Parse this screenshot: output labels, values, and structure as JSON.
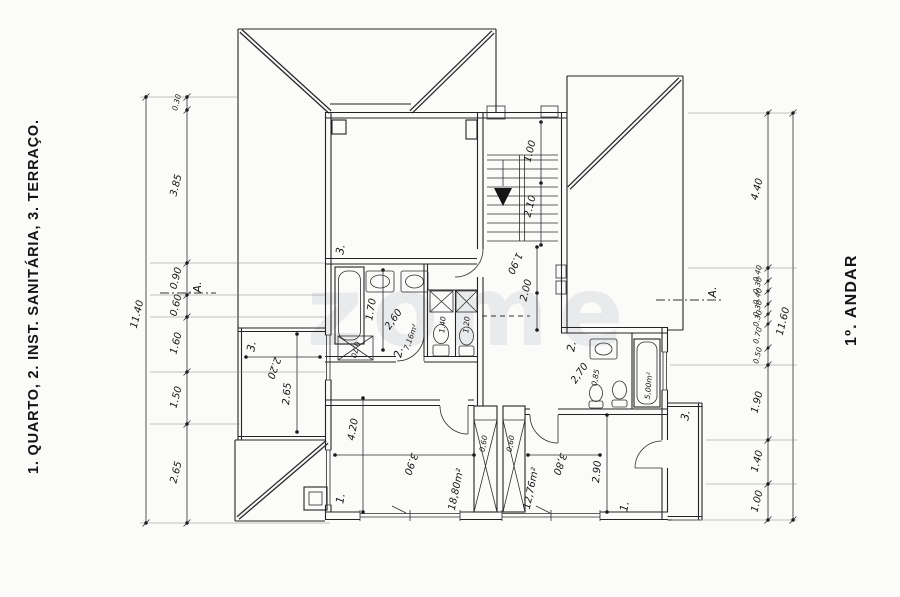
{
  "legend_text": "1. QUARTO, 2. INST.  SANITÁRIA, 3. TERRAÇO.",
  "floor_title": "1º. ANDAR",
  "watermark_text": "zome",
  "section_marker": "A.",
  "dims_left": {
    "total": "11.40",
    "seg1": "0.30",
    "seg2": "3.85",
    "seg3": "0.90",
    "seg4": "0.60",
    "seg5": "1.60",
    "seg6": "1.50",
    "seg7": "2.65"
  },
  "dims_right": {
    "total": "11.60",
    "seg1": "4.40",
    "c1": "0.40",
    "c2": "0.30",
    "c3": "0.40",
    "c4": "0.30",
    "c5": "0.30",
    "c6": "0.70",
    "c7": "0.50",
    "seg2": "1.90",
    "seg3": "1.40",
    "seg4": "1.00"
  },
  "stair": {
    "d1": "1.00",
    "d2": "2.10"
  },
  "hall": {
    "d1": "1.90",
    "d2": "2.00"
  },
  "bath_left": {
    "room_no": "2.",
    "area": "7,16m²",
    "d_tub": "1.70",
    "d_width": "2,60",
    "d_wc1": "1.40",
    "d_wc2": "1.20",
    "d_duct": "0,70"
  },
  "bath_right": {
    "room_no": "2.",
    "area": "5,00m²",
    "d1": "2,70",
    "d2": "0,85"
  },
  "bedroom_left": {
    "room_no": "1.",
    "area": "18,80m²",
    "d_w": "3.90",
    "d_h": "4.20",
    "d_duct": "0,60"
  },
  "bedroom_right": {
    "room_no": "1.",
    "area": "12,76m²",
    "d_w": "3,80",
    "d_h": "2.90",
    "d_duct": "0,60"
  },
  "terrace_top": {
    "room_no": "3."
  },
  "terrace_left": {
    "room_no": "3.",
    "d_w": "2.20",
    "d_h": "2.65"
  },
  "balcony_right": {
    "room_no": "3."
  }
}
